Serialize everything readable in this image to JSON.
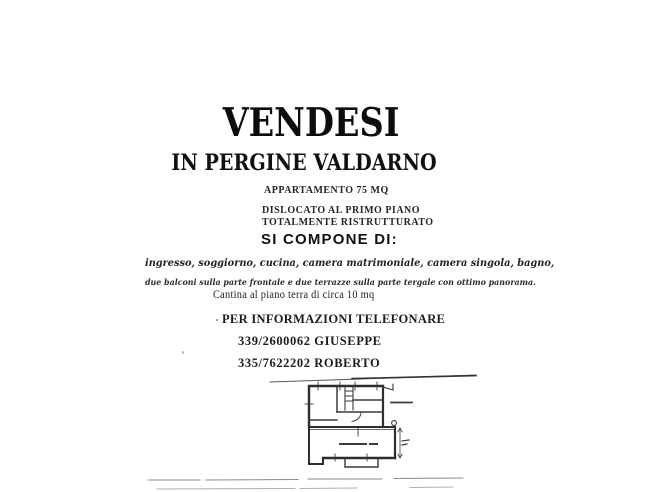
{
  "document": {
    "title": "VENDESI",
    "subtitle": "IN PERGINE VALDARNO",
    "details": [
      "APPARTAMENTO 75 MQ",
      "DISLOCATO AL PRIMO PIANO",
      "TOTALMENTE RISTRUTTURATO"
    ],
    "compose_heading": "SI COMPONE DI:",
    "rooms_line1": "ingresso, soggiorno, cucina, camera matrimoniale, camera singola, bagno,",
    "rooms_line2": "due balconi sulla parte frontale e due terrazze sulla parte tergale con ottimo panorama.",
    "cellar_line": "Cantina al piano terra di circa 10 mq",
    "contact_heading": "PER INFORMAZIONI TELEFONARE",
    "contact_lines": [
      "339/2600062 GIUSEPPE",
      "335/7622202 ROBERTO"
    ],
    "floor_plan_icon": "apartment-floor-plan-sketch",
    "colors": {
      "ink": "#1a1a1a",
      "plan_line": "#3a3a3a",
      "scan_artifact": "#9a9a9a"
    }
  }
}
